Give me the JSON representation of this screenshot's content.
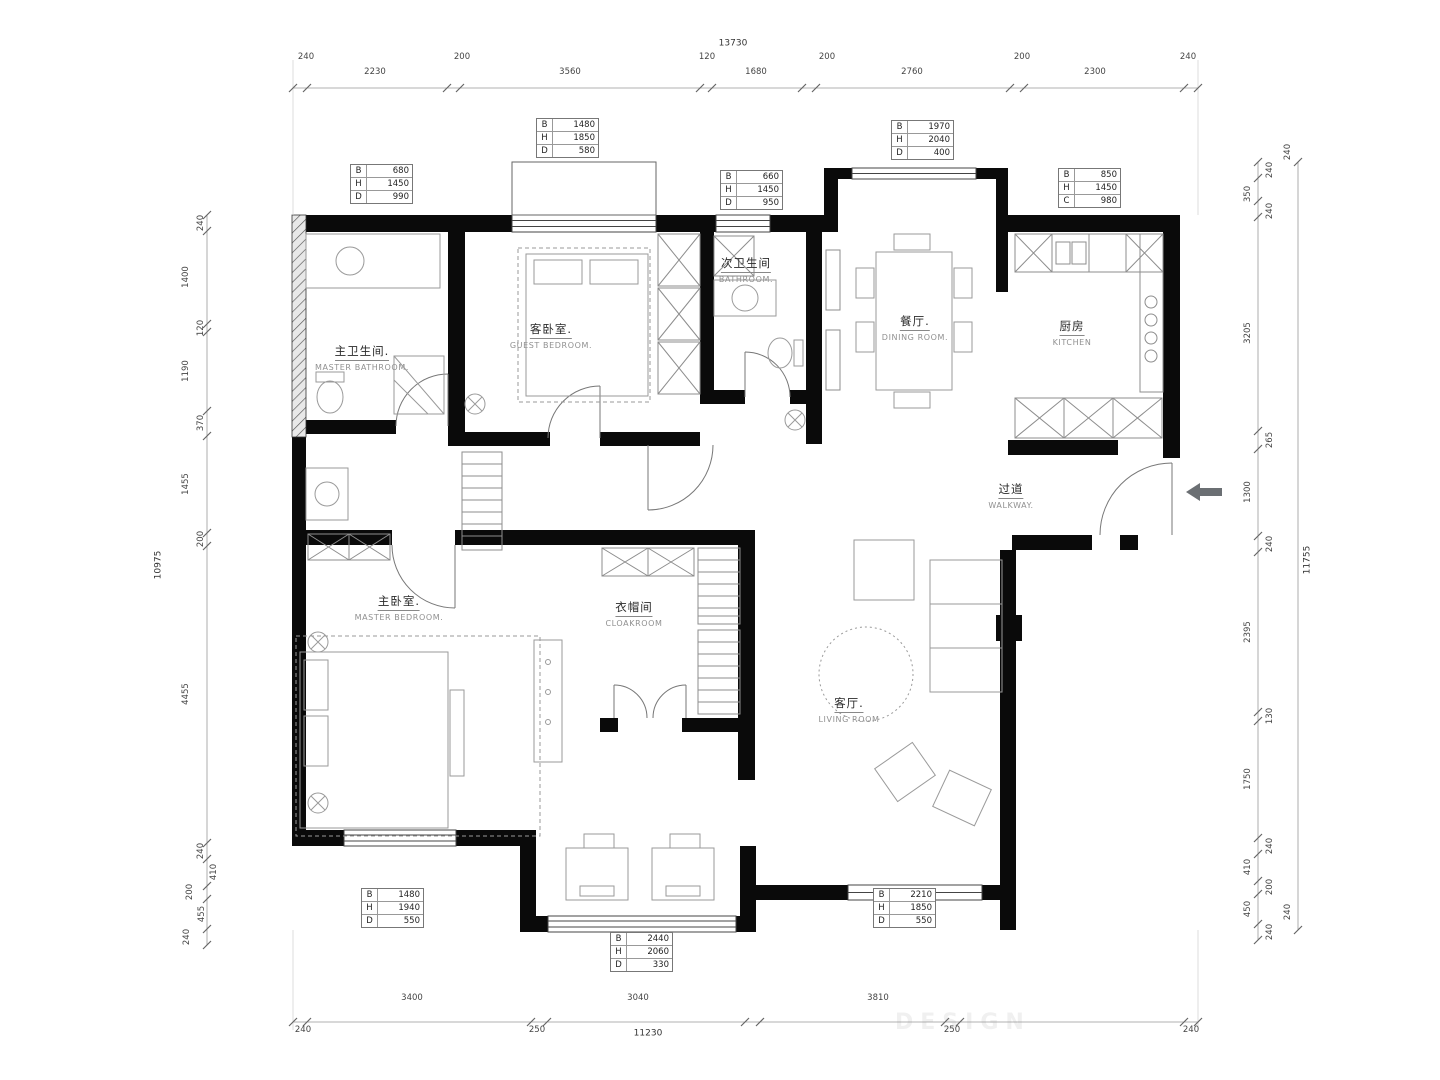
{
  "rooms": {
    "master_bath": {
      "zh": "主卫生间.",
      "en": "MASTER BATHROOM."
    },
    "guest_bedroom": {
      "zh": "客卧室.",
      "en": "GUEST BEDROOM."
    },
    "bathroom": {
      "zh": "次卫生间",
      "en": "BATHROOM."
    },
    "dining": {
      "zh": "餐厅.",
      "en": "DINING ROOM."
    },
    "kitchen": {
      "zh": "厨房",
      "en": "KITCHEN"
    },
    "walkway": {
      "zh": "过道",
      "en": "WALKWAY."
    },
    "master_bedroom": {
      "zh": "主卧室.",
      "en": "MASTER BEDROOM."
    },
    "cloakroom": {
      "zh": "衣帽间",
      "en": "CLOAKROOM"
    },
    "living": {
      "zh": "客厅.",
      "en": "LIVING ROOM"
    }
  },
  "schedules": [
    {
      "rows": [
        [
          "B",
          "680"
        ],
        [
          "H",
          "1450"
        ],
        [
          "D",
          "990"
        ]
      ]
    },
    {
      "rows": [
        [
          "B",
          "1480"
        ],
        [
          "H",
          "1850"
        ],
        [
          "D",
          "580"
        ]
      ]
    },
    {
      "rows": [
        [
          "B",
          "660"
        ],
        [
          "H",
          "1450"
        ],
        [
          "D",
          "950"
        ]
      ]
    },
    {
      "rows": [
        [
          "B",
          "1970"
        ],
        [
          "H",
          "2040"
        ],
        [
          "D",
          "400"
        ]
      ]
    },
    {
      "rows": [
        [
          "B",
          "850"
        ],
        [
          "H",
          "1450"
        ],
        [
          "C",
          "980"
        ]
      ]
    },
    {
      "rows": [
        [
          "B",
          "1480"
        ],
        [
          "H",
          "1940"
        ],
        [
          "D",
          "550"
        ]
      ]
    },
    {
      "rows": [
        [
          "B",
          "2440"
        ],
        [
          "H",
          "2060"
        ],
        [
          "D",
          "330"
        ]
      ]
    },
    {
      "rows": [
        [
          "B",
          "2210"
        ],
        [
          "H",
          "1850"
        ],
        [
          "D",
          "550"
        ]
      ]
    }
  ],
  "dims": {
    "top": {
      "total": "13730",
      "segs": [
        "240",
        "2230",
        "200",
        "3560",
        "120",
        "1680",
        "200",
        "2760",
        "200",
        "2300",
        "240"
      ]
    },
    "bottom": {
      "total": "11230",
      "segs": [
        "240",
        "3400",
        "250",
        "3040",
        "250",
        "3810",
        "240"
      ]
    },
    "left": {
      "total": "10975",
      "segs": [
        "240",
        "1400",
        "120",
        "1190",
        "370",
        "1455",
        "200",
        "4455",
        "240",
        "410",
        "200",
        "455",
        "240"
      ]
    },
    "right": {
      "total": "11755",
      "segs": [
        "240",
        "350",
        "240",
        "3205",
        "265",
        "1300",
        "240",
        "2395",
        "130",
        "1750",
        "240",
        "410",
        "200",
        "450",
        "240"
      ],
      "outer_top": "240",
      "outer_bottom": "240"
    }
  },
  "watermark": "DESIGN",
  "colors": {
    "wall": "#0a0a0a",
    "furniture": "#9a9a9a",
    "dimension": "#444444",
    "arrow": "#6b6f73"
  }
}
